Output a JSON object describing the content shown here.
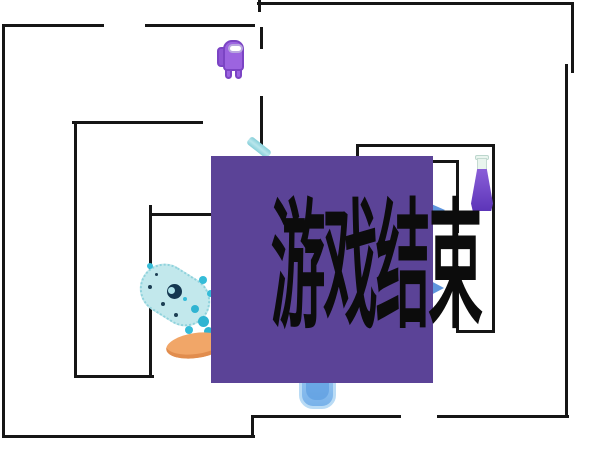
{
  "overlay": {
    "title": "游戏结束",
    "box": {
      "x": 211,
      "y": 156,
      "w": 222,
      "h": 227
    },
    "bg_color": "#5b4397",
    "text_color": "#0c0c0c"
  },
  "colors": {
    "background": "#ffffff",
    "wall": "#161616",
    "player_body": "#9c64e0",
    "player_outline": "#7b44c4",
    "player_visor": "#ffffff",
    "creature_body": "#c2e8ec",
    "creature_spot": "#35bcd8",
    "creature_eye": "#143750",
    "orange_blob": "#f1a668",
    "purple_potion": "#6f42c8",
    "blue_potion": "#79b2ea",
    "teal_item": "#86cfd9",
    "arrow_blue": "#5e95dd"
  },
  "walls": [
    {
      "x": 2,
      "y": 25,
      "w": 3,
      "h": 413
    },
    {
      "x": 2,
      "y": 435,
      "w": 253,
      "h": 3
    },
    {
      "x": 251,
      "y": 416,
      "w": 3,
      "h": 22
    },
    {
      "x": 251,
      "y": 415,
      "w": 150,
      "h": 3
    },
    {
      "x": 437,
      "y": 415,
      "w": 132,
      "h": 3
    },
    {
      "x": 565,
      "y": 64,
      "w": 3,
      "h": 354
    },
    {
      "x": 571,
      "y": 2,
      "w": 3,
      "h": 71
    },
    {
      "x": 257,
      "y": 2,
      "w": 317,
      "h": 3
    },
    {
      "x": 258,
      "y": 0,
      "w": 3,
      "h": 12
    },
    {
      "x": 2,
      "y": 24,
      "w": 102,
      "h": 3
    },
    {
      "x": 145,
      "y": 24,
      "w": 110,
      "h": 3
    },
    {
      "x": 260,
      "y": 27,
      "w": 3,
      "h": 22
    },
    {
      "x": 260,
      "y": 96,
      "w": 3,
      "h": 54
    },
    {
      "x": 72,
      "y": 121,
      "w": 131,
      "h": 3
    },
    {
      "x": 74,
      "y": 121,
      "w": 3,
      "h": 257
    },
    {
      "x": 74,
      "y": 375,
      "w": 80,
      "h": 3
    },
    {
      "x": 149,
      "y": 205,
      "w": 3,
      "h": 173
    },
    {
      "x": 151,
      "y": 213,
      "w": 64,
      "h": 3
    },
    {
      "x": 356,
      "y": 144,
      "w": 139,
      "h": 3
    },
    {
      "x": 356,
      "y": 144,
      "w": 3,
      "h": 14
    },
    {
      "x": 492,
      "y": 144,
      "w": 3,
      "h": 189
    },
    {
      "x": 456,
      "y": 330,
      "w": 39,
      "h": 3
    },
    {
      "x": 456,
      "y": 161,
      "w": 3,
      "h": 72
    },
    {
      "x": 456,
      "y": 266,
      "w": 3,
      "h": 67
    },
    {
      "x": 429,
      "y": 160,
      "w": 30,
      "h": 3
    }
  ],
  "sprites": {
    "player": {
      "box": {
        "x": 217,
        "y": 38,
        "w": 28,
        "h": 42
      }
    },
    "creature": {
      "box": {
        "x": 138,
        "y": 270,
        "w": 74,
        "h": 50
      }
    },
    "orange_blob": {
      "box": {
        "x": 166,
        "y": 333,
        "w": 60,
        "h": 25
      }
    },
    "purple_flask": {
      "box": {
        "x": 471,
        "y": 155,
        "w": 22,
        "h": 57
      }
    },
    "blue_flask": {
      "box": {
        "x": 299,
        "y": 364,
        "w": 37,
        "h": 45
      }
    },
    "teal_stripe": {
      "box": {
        "x": 246,
        "y": 143,
        "w": 26,
        "h": 9
      }
    },
    "arrow_top": {
      "box": {
        "x": 429,
        "y": 203,
        "w": 16,
        "h": 15
      }
    },
    "arrow_bottom": {
      "box": {
        "x": 429,
        "y": 280,
        "w": 15,
        "h": 16
      }
    }
  },
  "creature_spots": [
    {
      "x": 167,
      "y": 284,
      "d": 15,
      "c": "#143750",
      "name": "creature-eye-spot"
    },
    {
      "x": 168,
      "y": 287,
      "d": 7,
      "c": "#aee2e9",
      "name": "creature-eye-highlight"
    },
    {
      "x": 147,
      "y": 263,
      "d": 6,
      "c": "#35bcd8",
      "name": "creature-spot"
    },
    {
      "x": 199,
      "y": 276,
      "d": 8,
      "c": "#35bcd8",
      "name": "creature-spot"
    },
    {
      "x": 207,
      "y": 290,
      "d": 7,
      "c": "#35bcd8",
      "name": "creature-spot"
    },
    {
      "x": 183,
      "y": 297,
      "d": 4,
      "c": "#35bcd8",
      "name": "creature-spot"
    },
    {
      "x": 191,
      "y": 305,
      "d": 8,
      "c": "#2fb4d2",
      "name": "creature-spot"
    },
    {
      "x": 198,
      "y": 316,
      "d": 11,
      "c": "#2fb4d2",
      "name": "creature-spot"
    },
    {
      "x": 185,
      "y": 326,
      "d": 8,
      "c": "#35bcd8",
      "name": "creature-spot"
    },
    {
      "x": 204,
      "y": 327,
      "d": 9,
      "c": "#2fb4d2",
      "name": "creature-spot"
    },
    {
      "x": 212,
      "y": 300,
      "d": 6,
      "c": "#35bcd8",
      "name": "creature-splatter"
    },
    {
      "x": 211,
      "y": 315,
      "d": 7,
      "c": "#35bcd8",
      "name": "creature-splatter"
    },
    {
      "x": 148,
      "y": 285,
      "d": 4,
      "c": "#1c3e53",
      "name": "creature-dot"
    },
    {
      "x": 161,
      "y": 302,
      "d": 4,
      "c": "#1c3e53",
      "name": "creature-dot"
    },
    {
      "x": 174,
      "y": 313,
      "d": 4,
      "c": "#1c3e53",
      "name": "creature-dot"
    },
    {
      "x": 155,
      "y": 273,
      "d": 3,
      "c": "#1c3e53",
      "name": "creature-dot"
    }
  ]
}
